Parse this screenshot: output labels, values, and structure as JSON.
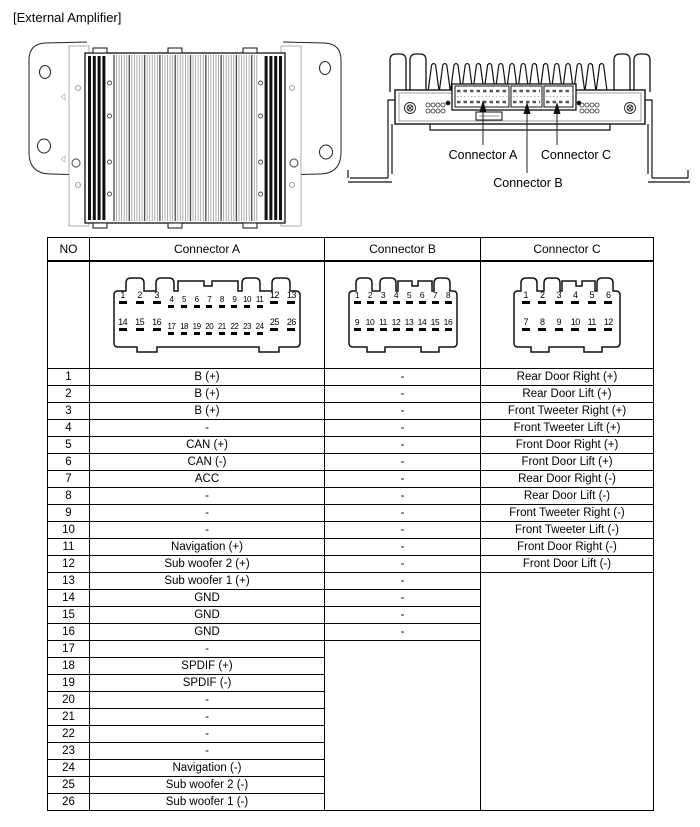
{
  "page": {
    "title": "[External Amplifier]"
  },
  "figures": {
    "top_view": {
      "connector_a_label": "Connector A",
      "connector_b_label": "Connector B",
      "connector_c_label": "Connector C"
    }
  },
  "table": {
    "headers": {
      "no": "NO",
      "a": "Connector A",
      "b": "Connector B",
      "c": "Connector C"
    },
    "connector_diagrams": {
      "a": {
        "top_groups": [
          {
            "size": "lg",
            "pins": [
              "1",
              "2",
              "3"
            ]
          },
          {
            "size": "sm",
            "pins": [
              "4",
              "5",
              "6",
              "7",
              "8",
              "9",
              "10",
              "11"
            ]
          },
          {
            "size": "lg",
            "pins": [
              "12",
              "13"
            ]
          }
        ],
        "bottom_groups": [
          {
            "size": "lg",
            "pins": [
              "14",
              "15",
              "16"
            ]
          },
          {
            "size": "sm",
            "pins": [
              "17",
              "18",
              "19",
              "20",
              "21",
              "22",
              "23",
              "24"
            ]
          },
          {
            "size": "lg",
            "pins": [
              "25",
              "26"
            ]
          }
        ]
      },
      "b": {
        "top_groups": [
          {
            "size": "plain",
            "pins": [
              "1",
              "2",
              "3",
              "4",
              "5",
              "6",
              "7",
              "8"
            ]
          }
        ],
        "bottom_groups": [
          {
            "size": "plain",
            "pins": [
              "9",
              "10",
              "11",
              "12",
              "13",
              "14",
              "15",
              "16"
            ]
          }
        ]
      },
      "c": {
        "top_groups": [
          {
            "size": "plain",
            "pins": [
              "1",
              "2",
              "3",
              "4",
              "5",
              "6"
            ]
          }
        ],
        "bottom_groups": [
          {
            "size": "plain",
            "pins": [
              "7",
              "8",
              "9",
              "10",
              "11",
              "12"
            ]
          }
        ]
      }
    },
    "rows": [
      {
        "no": "1",
        "a": "B (+)",
        "b": "-",
        "c": "Rear Door Right (+)"
      },
      {
        "no": "2",
        "a": "B (+)",
        "b": "-",
        "c": "Rear Door Lift (+)"
      },
      {
        "no": "3",
        "a": "B (+)",
        "b": "-",
        "c": "Front Tweeter Right (+)"
      },
      {
        "no": "4",
        "a": "-",
        "b": "-",
        "c": "Front Tweeter Lift (+)"
      },
      {
        "no": "5",
        "a": "CAN (+)",
        "b": "-",
        "c": "Front Door Right (+)"
      },
      {
        "no": "6",
        "a": "CAN (-)",
        "b": "-",
        "c": "Front Door Lift (+)"
      },
      {
        "no": "7",
        "a": "ACC",
        "b": "-",
        "c": "Rear Door Right (-)"
      },
      {
        "no": "8",
        "a": "-",
        "b": "-",
        "c": "Rear Door Lift  (-)"
      },
      {
        "no": "9",
        "a": "-",
        "b": "-",
        "c": "Front Tweeter Right (-)"
      },
      {
        "no": "10",
        "a": "-",
        "b": "-",
        "c": "Front Tweeter Lift (-)"
      },
      {
        "no": "11",
        "a": "Navigation (+)",
        "b": "-",
        "c": "Front Door Right (-)"
      },
      {
        "no": "12",
        "a": "Sub woofer 2 (+)",
        "b": "-",
        "c": "Front Door Lift (-)"
      },
      {
        "no": "13",
        "a": "Sub woofer 1 (+)",
        "b": "-",
        "c": null
      },
      {
        "no": "14",
        "a": "GND",
        "b": "-",
        "c": null
      },
      {
        "no": "15",
        "a": "GND",
        "b": "-",
        "c": null
      },
      {
        "no": "16",
        "a": "GND",
        "b": "-",
        "c": null
      },
      {
        "no": "17",
        "a": "-",
        "b": null,
        "c": null
      },
      {
        "no": "18",
        "a": "SPDIF (+)",
        "b": null,
        "c": null
      },
      {
        "no": "19",
        "a": "SPDIF (-)",
        "b": null,
        "c": null
      },
      {
        "no": "20",
        "a": "-",
        "b": null,
        "c": null
      },
      {
        "no": "21",
        "a": "-",
        "b": null,
        "c": null
      },
      {
        "no": "22",
        "a": "-",
        "b": null,
        "c": null
      },
      {
        "no": "23",
        "a": "-",
        "b": null,
        "c": null
      },
      {
        "no": "24",
        "a": "Navigation (-)",
        "b": null,
        "c": null
      },
      {
        "no": "25",
        "a": "Sub woofer 2 (-)",
        "b": null,
        "c": null
      },
      {
        "no": "26",
        "a": "Sub woofer 1 (-)",
        "b": null,
        "c": null
      }
    ]
  },
  "colors": {
    "ink": "#000000",
    "background": "#ffffff"
  }
}
